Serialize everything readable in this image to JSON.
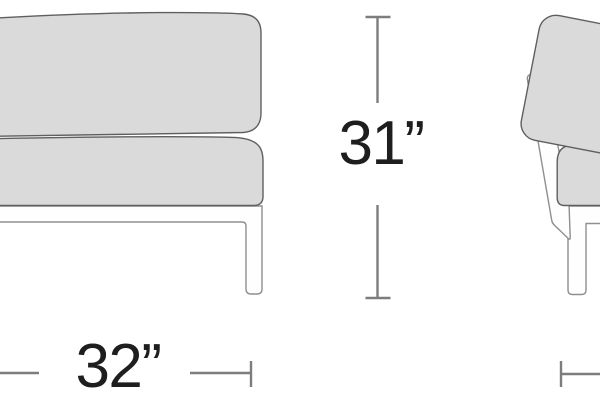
{
  "dimensions": {
    "width": {
      "label": "32”"
    },
    "height": {
      "label": "31”"
    }
  },
  "colors": {
    "background": "#ffffff",
    "cushion_fill": "#dadada",
    "cushion_outline": "#5f5f5f",
    "frame_fill": "#fefefe",
    "frame_outline": "#8f8f8f",
    "dimension_line": "#7d7d7d",
    "label_text": "#1e1e1e"
  }
}
